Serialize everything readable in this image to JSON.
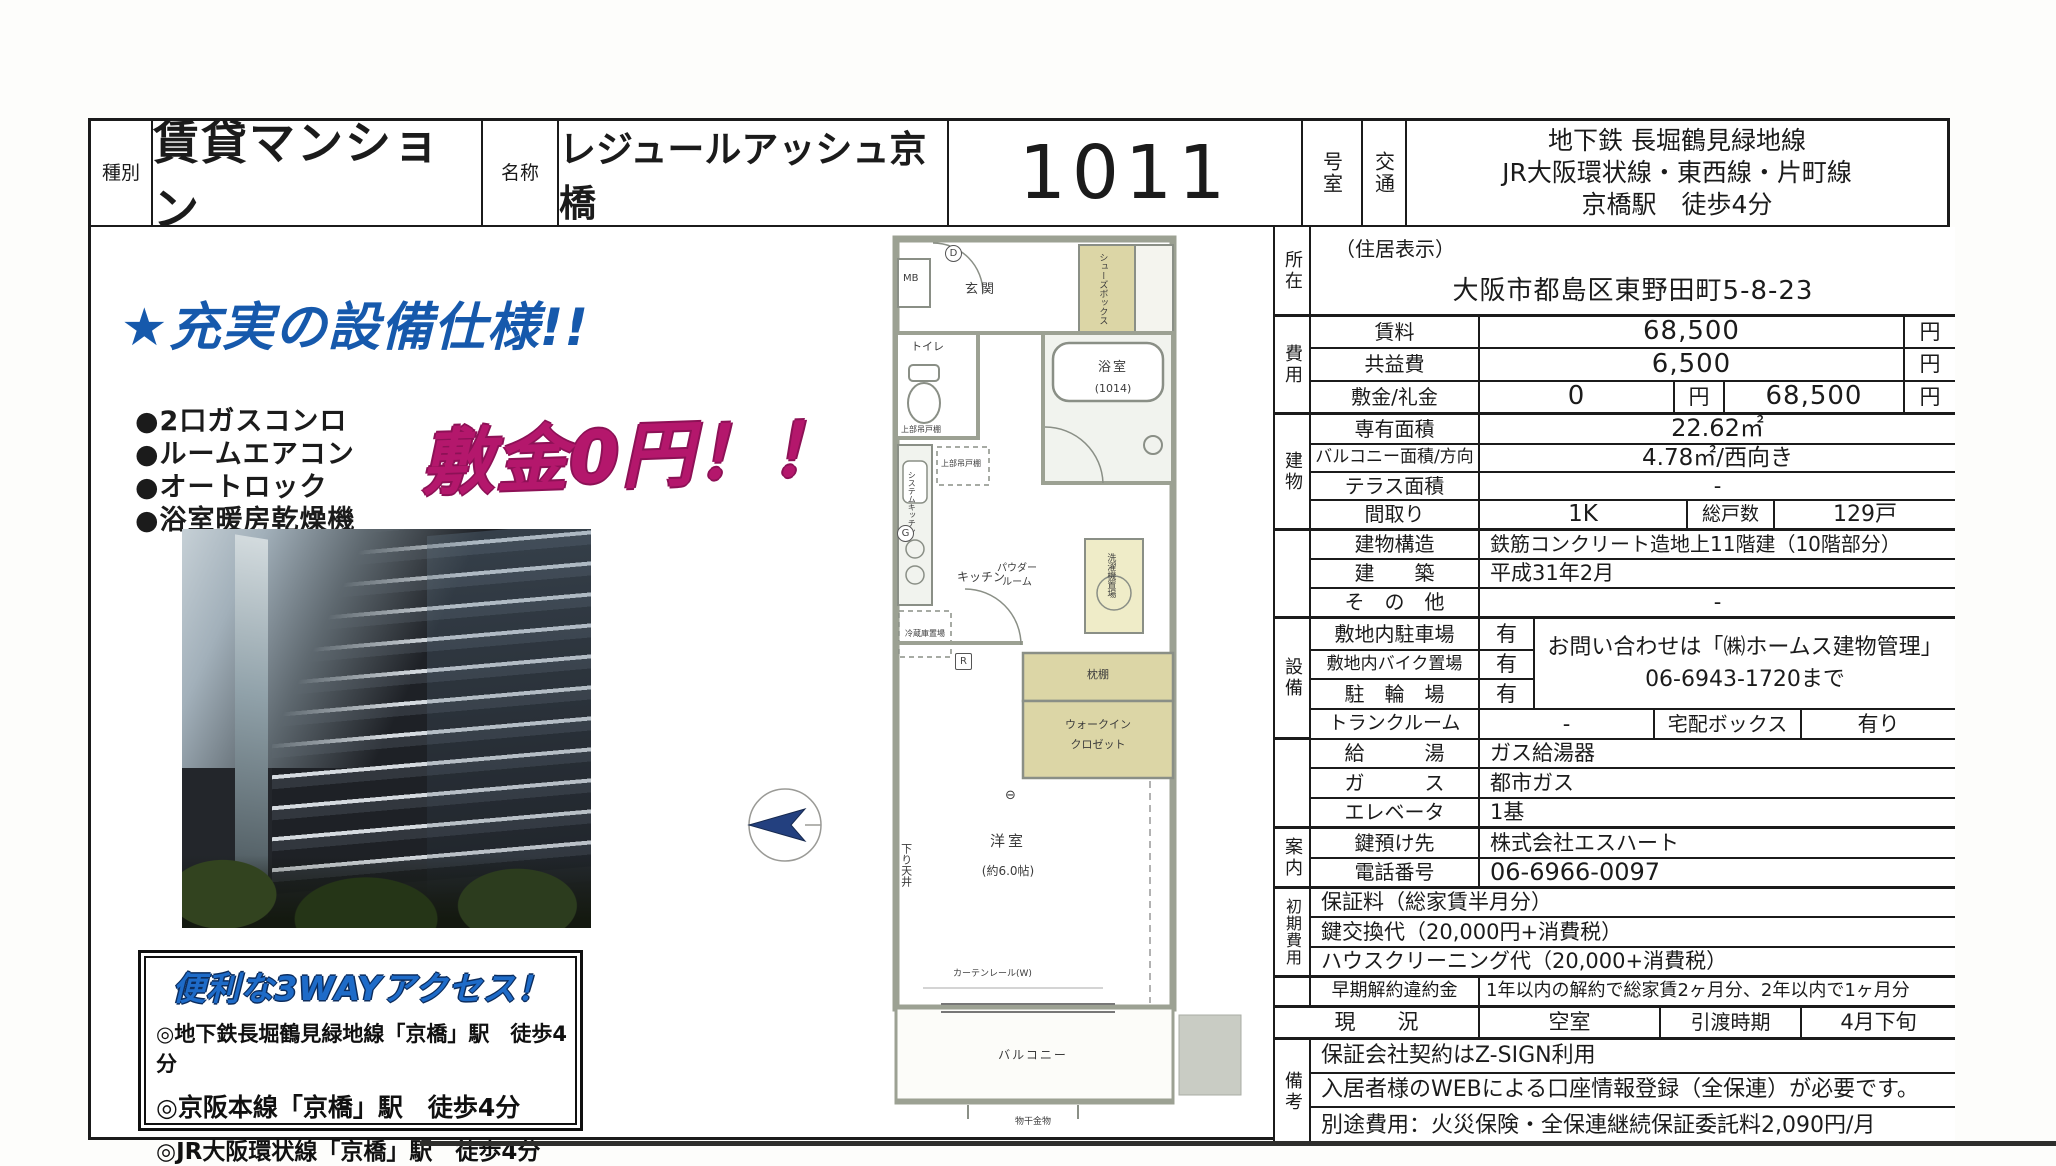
{
  "header": {
    "type_label": "種別",
    "type_value": "賃貸マンション",
    "name_label": "名称",
    "name_value": "レジュールアッシュ京橋",
    "room_number": "1011",
    "room_suffix": "号室",
    "transport_label": "交通",
    "transport_lines": [
      "地下鉄 長堀鶴見緑地線",
      "JR大阪環状線・東西線・片町線",
      "京橋駅　徒歩4分"
    ]
  },
  "promo": {
    "headline": "★充実の設備仕様!!",
    "features": [
      "●2口ガスコンロ",
      "●ルームエアコン",
      "●オートロック",
      "●浴室暖房乾燥機"
    ],
    "highlight": "敷金0円！！",
    "access_title": "便利な3WAYアクセス！",
    "access_lines": [
      "◎地下鉄長堀鶴見緑地線「京橋」駅　徒歩4分",
      "◎京阪本線「京橋」駅　徒歩4分",
      "◎JR大阪環状線「京橋」駅　徒歩4分"
    ],
    "colors": {
      "headline_blue": "#1659ac",
      "highlight_magenta": "#b4176c",
      "access_blue": "#1e6bc8"
    }
  },
  "floorplan": {
    "genkan": "玄関",
    "mb": "MB",
    "shoes_box": "シューズボックス",
    "toilet": "トイレ",
    "toilet_shelf": "上部吊戸棚",
    "bath": "浴室",
    "bath_size": "(1014)",
    "kitchen": "キッチン",
    "system_kitchen": "システムキッチン",
    "kitchen_shelf": "上部吊戸棚",
    "fridge": "冷蔵庫置場",
    "powder1": "パウダー",
    "powder2": "ルーム",
    "washer": "洗濯機置場",
    "shelf": "枕棚",
    "walkin1": "ウォークイン",
    "walkin2": "クロゼット",
    "western_room": "洋室",
    "western_room_size": "(約6.0帖)",
    "curtain_rail": "カーテンレール(W)",
    "lowered_ceiling": "下り天井",
    "balcony": "バルコニー",
    "drying_fixture": "物干金物",
    "mark_d": "D",
    "mark_g": "G",
    "mark_r": "R",
    "window_mark": "⊖"
  },
  "table": {
    "shozai": {
      "section": "所在",
      "note": "（住居表示）",
      "address": "大阪市都島区東野田町5-8-23"
    },
    "hiyo": {
      "section": "費用",
      "chinryo_label": "賃料",
      "chinryo_value": "68,500",
      "chinryo_unit": "円",
      "kyoekihi_label": "共益費",
      "kyoekihi_value": "6,500",
      "kyoekihi_unit": "円",
      "shikirei_label": "敷金/礼金",
      "shikirei_v1": "0",
      "shikirei_u1": "円",
      "shikirei_v2": "68,500",
      "shikirei_u2": "円"
    },
    "tatemono": {
      "section": "建物",
      "senyu_label": "専有面積",
      "senyu_value": "22.62㎡",
      "balcony_label": "バルコニー面積/方向",
      "balcony_value": "4.78㎡/西向き",
      "terrace_label": "テラス面積",
      "terrace_value": "-",
      "madori_label": "間取り",
      "madori_value": "1K",
      "soukosu_label": "総戸数",
      "soukosu_value": "129戸",
      "kozo_label": "建物構造",
      "kozo_value": "鉄筋コンクリート造地上11階建（10階部分）",
      "chiku_label": "建　　築",
      "chiku_value": "平成31年2月",
      "sonota_label": "そ　の　他",
      "sonota_value": "-"
    },
    "setsubi": {
      "section": "設備",
      "parking_label": "敷地内駐車場",
      "parking_value": "有",
      "bike_label": "敷地内バイク置場",
      "bike_value": "有",
      "bicycle_label": "駐　輪　場",
      "bicycle_value": "有",
      "contact_line1": "お問い合わせは「㈱ホームス建物管理」",
      "contact_line2": "06-6943-1720まで",
      "trunk_label": "トランクルーム",
      "trunk_value": "-",
      "delivery_label": "宅配ボックス",
      "delivery_value": "有り",
      "kyuto_label": "給　　　湯",
      "kyuto_value": "ガス給湯器",
      "gas_label": "ガ　　　ス",
      "gas_value": "都市ガス",
      "elevator_label": "エレベータ",
      "elevator_value": "1基"
    },
    "annai": {
      "section": "案内",
      "key_label": "鍵預け先",
      "key_value": "株式会社エスハート",
      "tel_label": "電話番号",
      "tel_value": "06-6966-0097"
    },
    "shokihiyo": {
      "section": "初期費用",
      "lines": [
        "保証料（総家賃半月分）",
        "鍵交換代（20,000円+消費税）",
        "ハウスクリーニング代（20,000+消費税）"
      ]
    },
    "sokai": {
      "label": "早期解約違約金",
      "value": "1年以内の解約で総家賃2ヶ月分、2年以内で1ヶ月分"
    },
    "genkyo": {
      "label": "現　　況",
      "value": "空室",
      "handover_label": "引渡時期",
      "handover_value": "4月下旬"
    },
    "biko": {
      "section": "備考",
      "lines": [
        "保証会社契約はZ-SIGN利用",
        "入居者様のWEBによる口座情報登録（全保連）が必要です。",
        "別途費用：火災保険・全保連継続保証委託料2,090円/月"
      ]
    }
  }
}
